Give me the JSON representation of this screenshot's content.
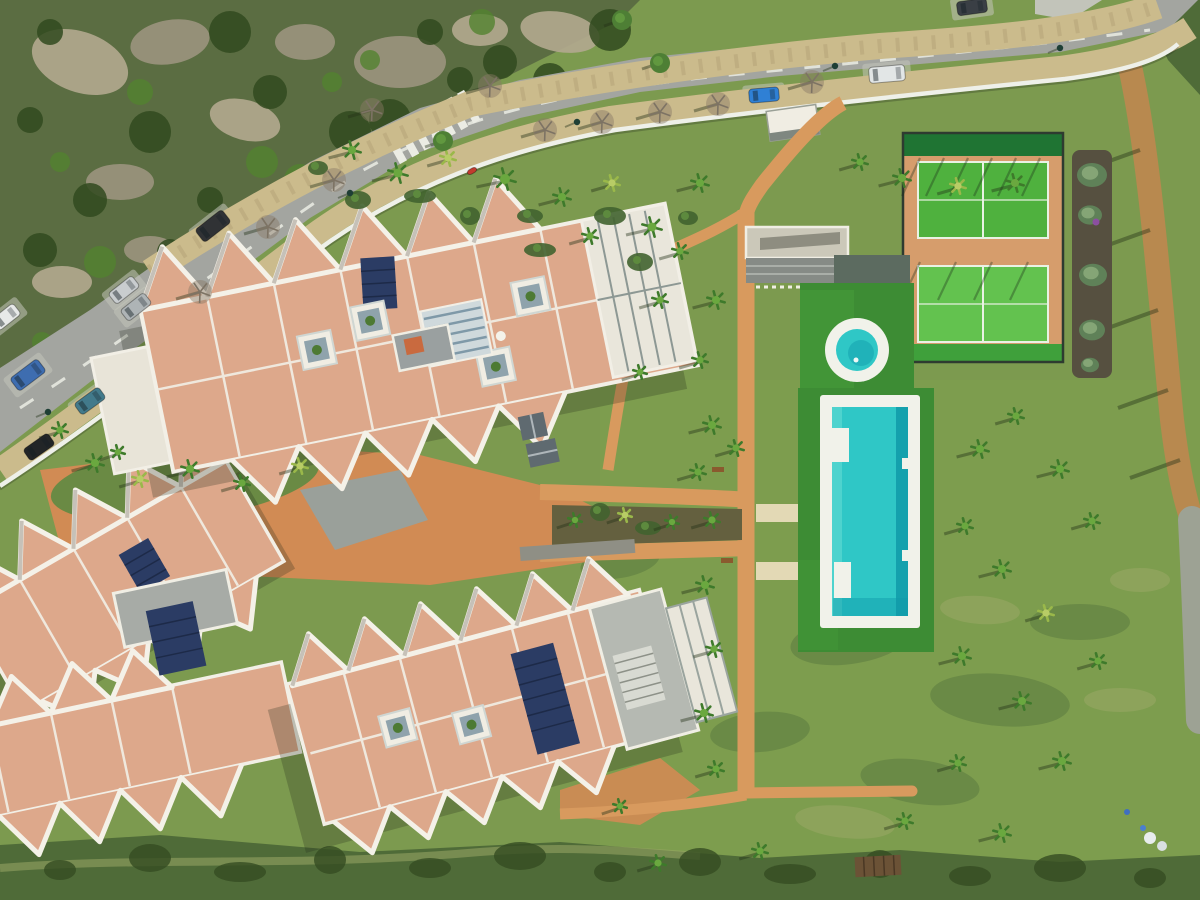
{
  "scene": {
    "name": "aerial-drone-view-residential-complex",
    "features": [
      "curved-road",
      "rocky-hillside",
      "apartment-blocks-zigzag-roofs",
      "orange-paths",
      "lap-pool",
      "round-plunge-pool",
      "padel-courts",
      "gardens",
      "scrubland"
    ]
  },
  "palette": {
    "grass": "#7c9a4f",
    "grassd": "#6a8a44",
    "meadow": "#7fa04e",
    "patchd": "#5b7a40",
    "patchl": "#9aa766",
    "scrub": "#4f6b38",
    "scrubd": "#344c22",
    "hill": "#5b6d42",
    "rock": "#9b947e",
    "rockl": "#b2a98f",
    "bushd": "#314a1e",
    "bushb": "#538230",
    "road": "#a3a5a0",
    "bay": "#c2c4ba",
    "mark": "#ebece4",
    "walk": "#cbbb8c",
    "walkdot": "#a8996d",
    "wall": "#eef0e9",
    "path": "#d89a5e",
    "plaza": "#d18b54",
    "pathpale": "#e3d9b5",
    "soilbed": "#64603f",
    "gravel": "#8f8f85",
    "roof": "#dda88b",
    "roofd": "#c98f70",
    "ridge": "#f4f1e8",
    "bwhite": "#f0ede3",
    "slate": "#5f6a70",
    "grayroof": "#b5b9b2",
    "solar": "#2b3c64",
    "solarline": "#1d2a48",
    "court": "#4fb13e",
    "courtl": "#63c24f",
    "courtbandd": "#1f7433",
    "courtbandb": "#3fa03b",
    "courttc": "#d69d6c",
    "fence": "#2e3b30",
    "turf": "#3d8c34",
    "turfl": "#4aa23d",
    "pool": "#2fc7c6",
    "poold": "#0f9aa8",
    "pooll": "#56d6cf",
    "deck": "#f1f2ea",
    "soil": "#565040",
    "bedbush": "#5f8158",
    "bedbushl": "#8fae7e",
    "purple": "#8b4fa0",
    "trail": "#b8894f",
    "trailg": "#9da294",
    "palm": "#3e7a2b",
    "palml": "#6aa83f",
    "palmy": "#9ab84a",
    "shadow": "rgba(35,50,25,0.42)",
    "atrium": "#8fa3ac",
    "bench": "#8a5a2e",
    "pallet": "#6b5236"
  },
  "cars": [
    {
      "name": "dark-van",
      "x": 213,
      "y": 226,
      "w": 34,
      "h": 16,
      "a": -38,
      "c": "#303235"
    },
    {
      "name": "silver-car",
      "x": 124,
      "y": 290,
      "w": 30,
      "h": 14,
      "a": -38,
      "c": "#c9cdcf"
    },
    {
      "name": "gray-car",
      "x": 136,
      "y": 307,
      "w": 30,
      "h": 14,
      "a": -38,
      "c": "#aeb4b6"
    },
    {
      "name": "white-car",
      "x": 6,
      "y": 317,
      "w": 28,
      "h": 14,
      "a": -38,
      "c": "#e7e9e8"
    },
    {
      "name": "blue-van",
      "x": 28,
      "y": 375,
      "w": 34,
      "h": 16,
      "a": -37,
      "c": "#3e6db0"
    },
    {
      "name": "teal-car",
      "x": 90,
      "y": 401,
      "w": 30,
      "h": 14,
      "a": -36,
      "c": "#427a8b"
    },
    {
      "name": "black-car",
      "x": 39,
      "y": 447,
      "w": 30,
      "h": 14,
      "a": -35,
      "c": "#222527"
    },
    {
      "name": "blue-car",
      "x": 764,
      "y": 95,
      "w": 30,
      "h": 14,
      "a": -5,
      "c": "#2f80d5"
    },
    {
      "name": "white-van",
      "x": 887,
      "y": 74,
      "w": 36,
      "h": 16,
      "a": -5,
      "c": "#e2e6e6"
    },
    {
      "name": "dark-car",
      "x": 972,
      "y": 7,
      "w": 30,
      "h": 14,
      "a": -8,
      "c": "#3a3f45"
    },
    {
      "name": "red-moped",
      "x": 472,
      "y": 171,
      "w": 10,
      "h": 5,
      "a": -30,
      "c": "#c23b2e"
    }
  ],
  "palms": [
    {
      "x": 352,
      "y": 150,
      "r": 9
    },
    {
      "x": 398,
      "y": 173,
      "r": 10
    },
    {
      "x": 448,
      "y": 158,
      "r": 8,
      "t": 1
    },
    {
      "x": 505,
      "y": 179,
      "r": 11
    },
    {
      "x": 562,
      "y": 197,
      "r": 9
    },
    {
      "x": 612,
      "y": 183,
      "r": 8,
      "t": 1
    },
    {
      "x": 652,
      "y": 227,
      "r": 10
    },
    {
      "x": 700,
      "y": 183,
      "r": 9
    },
    {
      "x": 590,
      "y": 236,
      "r": 8
    },
    {
      "x": 680,
      "y": 251,
      "r": 8
    },
    {
      "x": 860,
      "y": 162,
      "r": 8
    },
    {
      "x": 902,
      "y": 178,
      "r": 9
    },
    {
      "x": 958,
      "y": 186,
      "r": 8,
      "t": 1
    },
    {
      "x": 1015,
      "y": 183,
      "r": 9
    },
    {
      "x": 716,
      "y": 300,
      "r": 9
    },
    {
      "x": 700,
      "y": 360,
      "r": 8
    },
    {
      "x": 712,
      "y": 425,
      "r": 9
    },
    {
      "x": 736,
      "y": 448,
      "r": 8
    },
    {
      "x": 698,
      "y": 472,
      "r": 8
    },
    {
      "x": 712,
      "y": 520,
      "r": 8
    },
    {
      "x": 705,
      "y": 585,
      "r": 9
    },
    {
      "x": 714,
      "y": 649,
      "r": 8
    },
    {
      "x": 704,
      "y": 713,
      "r": 9
    },
    {
      "x": 716,
      "y": 769,
      "r": 8
    },
    {
      "x": 980,
      "y": 449,
      "r": 9
    },
    {
      "x": 1016,
      "y": 416,
      "r": 8
    },
    {
      "x": 1060,
      "y": 469,
      "r": 9
    },
    {
      "x": 1092,
      "y": 521,
      "r": 8
    },
    {
      "x": 965,
      "y": 526,
      "r": 8
    },
    {
      "x": 1002,
      "y": 569,
      "r": 9
    },
    {
      "x": 1046,
      "y": 613,
      "r": 8,
      "t": 1
    },
    {
      "x": 962,
      "y": 656,
      "r": 9
    },
    {
      "x": 1098,
      "y": 661,
      "r": 8
    },
    {
      "x": 1022,
      "y": 701,
      "r": 9
    },
    {
      "x": 958,
      "y": 763,
      "r": 8
    },
    {
      "x": 1062,
      "y": 761,
      "r": 9
    },
    {
      "x": 905,
      "y": 821,
      "r": 8
    },
    {
      "x": 1002,
      "y": 833,
      "r": 9
    },
    {
      "x": 760,
      "y": 851,
      "r": 8
    },
    {
      "x": 658,
      "y": 863,
      "r": 8
    },
    {
      "x": 620,
      "y": 806,
      "r": 7
    },
    {
      "x": 95,
      "y": 463,
      "r": 9
    },
    {
      "x": 140,
      "y": 479,
      "r": 8,
      "t": 1
    },
    {
      "x": 190,
      "y": 469,
      "r": 9
    },
    {
      "x": 242,
      "y": 483,
      "r": 8
    },
    {
      "x": 300,
      "y": 466,
      "r": 8,
      "t": 1
    },
    {
      "x": 575,
      "y": 520,
      "r": 7
    },
    {
      "x": 625,
      "y": 515,
      "r": 7,
      "t": 1
    },
    {
      "x": 672,
      "y": 522,
      "r": 7
    },
    {
      "x": 660,
      "y": 300,
      "r": 8
    },
    {
      "x": 640,
      "y": 372,
      "r": 7
    },
    {
      "x": 60,
      "y": 430,
      "r": 8
    },
    {
      "x": 118,
      "y": 452,
      "r": 7
    }
  ],
  "bare_trees": [
    {
      "x": 200,
      "y": 292
    },
    {
      "x": 268,
      "y": 227
    },
    {
      "x": 334,
      "y": 180
    },
    {
      "x": 372,
      "y": 110
    },
    {
      "x": 490,
      "y": 86
    },
    {
      "x": 545,
      "y": 130
    },
    {
      "x": 602,
      "y": 122
    },
    {
      "x": 660,
      "y": 112
    },
    {
      "x": 718,
      "y": 104
    },
    {
      "x": 812,
      "y": 82
    }
  ],
  "green_trees": [
    {
      "x": 443,
      "y": 141
    },
    {
      "x": 622,
      "y": 20
    },
    {
      "x": 660,
      "y": 63
    }
  ],
  "street_lights": [
    {
      "x": 350,
      "y": 193
    },
    {
      "x": 577,
      "y": 122
    },
    {
      "x": 835,
      "y": 66
    },
    {
      "x": 1060,
      "y": 48
    },
    {
      "x": 48,
      "y": 412
    }
  ],
  "shrubs": [
    {
      "x": 318,
      "y": 168
    },
    {
      "x": 358,
      "y": 200
    },
    {
      "x": 420,
      "y": 196
    },
    {
      "x": 470,
      "y": 216
    },
    {
      "x": 530,
      "y": 216
    },
    {
      "x": 610,
      "y": 216
    },
    {
      "x": 688,
      "y": 218
    },
    {
      "x": 640,
      "y": 262
    },
    {
      "x": 540,
      "y": 250
    },
    {
      "x": 600,
      "y": 512
    },
    {
      "x": 648,
      "y": 528
    }
  ],
  "bed_bushes": [
    {
      "x": 1092,
      "y": 175,
      "r": 15
    },
    {
      "x": 1090,
      "y": 215,
      "r": 12
    },
    {
      "x": 1093,
      "y": 275,
      "r": 14
    },
    {
      "x": 1092,
      "y": 330,
      "r": 13
    },
    {
      "x": 1090,
      "y": 365,
      "r": 9
    }
  ],
  "meadow_patches": [
    {
      "x": 850,
      "y": 640,
      "rx": 60,
      "ry": 24,
      "a": -8,
      "t": "d"
    },
    {
      "x": 1000,
      "y": 700,
      "rx": 70,
      "ry": 26,
      "a": 5,
      "t": "d"
    },
    {
      "x": 760,
      "y": 732,
      "rx": 50,
      "ry": 20,
      "a": -5,
      "t": "d"
    },
    {
      "x": 920,
      "y": 782,
      "rx": 60,
      "ry": 22,
      "a": 8,
      "t": "d"
    },
    {
      "x": 1080,
      "y": 622,
      "rx": 50,
      "ry": 18,
      "a": 0,
      "t": "d"
    },
    {
      "x": 620,
      "y": 562,
      "rx": 40,
      "ry": 16,
      "a": -10,
      "t": "d"
    },
    {
      "x": 890,
      "y": 560,
      "rx": 42,
      "ry": 14,
      "a": 0,
      "t": "l"
    },
    {
      "x": 1120,
      "y": 700,
      "rx": 36,
      "ry": 12,
      "a": 0,
      "t": "l"
    },
    {
      "x": 845,
      "y": 822,
      "rx": 50,
      "ry": 16,
      "a": 6,
      "t": "l"
    },
    {
      "x": 1140,
      "y": 580,
      "rx": 30,
      "ry": 12,
      "a": 0,
      "t": "l"
    },
    {
      "x": 980,
      "y": 610,
      "rx": 40,
      "ry": 14,
      "a": 4,
      "t": "l"
    },
    {
      "x": 500,
      "y": 545,
      "rx": 35,
      "ry": 13,
      "a": -6,
      "t": "d"
    }
  ],
  "scrub_blobs": [
    {
      "x": 60,
      "y": 870
    },
    {
      "x": 150,
      "y": 858
    },
    {
      "x": 240,
      "y": 872
    },
    {
      "x": 330,
      "y": 860
    },
    {
      "x": 430,
      "y": 868
    },
    {
      "x": 520,
      "y": 856
    },
    {
      "x": 610,
      "y": 872
    },
    {
      "x": 700,
      "y": 862
    },
    {
      "x": 790,
      "y": 874
    },
    {
      "x": 880,
      "y": 864
    },
    {
      "x": 970,
      "y": 876
    },
    {
      "x": 1060,
      "y": 868
    },
    {
      "x": 1150,
      "y": 878
    }
  ],
  "rocks": [
    {
      "x": 80,
      "y": 62,
      "rx": 50,
      "ry": 30,
      "a": 20
    },
    {
      "x": 170,
      "y": 42,
      "rx": 40,
      "ry": 22,
      "a": -10
    },
    {
      "x": 245,
      "y": 120,
      "rx": 36,
      "ry": 20,
      "a": 15
    },
    {
      "x": 400,
      "y": 62,
      "rx": 46,
      "ry": 26,
      "a": 0
    },
    {
      "x": 560,
      "y": 32,
      "rx": 40,
      "ry": 20,
      "a": 10
    },
    {
      "x": 120,
      "y": 182,
      "rx": 34,
      "ry": 18,
      "a": 0
    },
    {
      "x": 62,
      "y": 282,
      "rx": 30,
      "ry": 16,
      "a": 0
    },
    {
      "x": 305,
      "y": 42,
      "rx": 30,
      "ry": 18,
      "a": 0
    },
    {
      "x": 480,
      "y": 30,
      "rx": 28,
      "ry": 16,
      "a": 0
    },
    {
      "x": 150,
      "y": 250,
      "rx": 26,
      "ry": 14,
      "a": 0
    }
  ],
  "hill_bushes_dark": [
    {
      "x": 30,
      "y": 120
    },
    {
      "x": 90,
      "y": 200
    },
    {
      "x": 150,
      "y": 132
    },
    {
      "x": 210,
      "y": 200
    },
    {
      "x": 270,
      "y": 92
    },
    {
      "x": 350,
      "y": 132
    },
    {
      "x": 430,
      "y": 32
    },
    {
      "x": 500,
      "y": 62
    },
    {
      "x": 230,
      "y": 32
    },
    {
      "x": 50,
      "y": 32
    },
    {
      "x": 120,
      "y": 322
    },
    {
      "x": 200,
      "y": 302
    },
    {
      "x": 170,
      "y": 252
    },
    {
      "x": 260,
      "y": 222
    },
    {
      "x": 390,
      "y": 120
    },
    {
      "x": 460,
      "y": 80
    },
    {
      "x": 550,
      "y": 80
    },
    {
      "x": 610,
      "y": 30
    },
    {
      "x": 90,
      "y": 330
    },
    {
      "x": 40,
      "y": 250
    }
  ],
  "hill_bushes_bright": [
    {
      "x": 60,
      "y": 162
    },
    {
      "x": 140,
      "y": 92
    },
    {
      "x": 262,
      "y": 162
    },
    {
      "x": 332,
      "y": 82
    },
    {
      "x": 482,
      "y": 22
    },
    {
      "x": 100,
      "y": 262
    },
    {
      "x": 42,
      "y": 342
    },
    {
      "x": 202,
      "y": 262
    },
    {
      "x": 300,
      "y": 180
    },
    {
      "x": 370,
      "y": 60
    }
  ],
  "trail_shadows": [
    {
      "x": 1140,
      "y": 150
    },
    {
      "x": 1150,
      "y": 230
    },
    {
      "x": 1158,
      "y": 310
    },
    {
      "x": 1168,
      "y": 390
    },
    {
      "x": 1180,
      "y": 460
    }
  ],
  "debris": [
    {
      "x": 1150,
      "y": 838,
      "c": "#e8ecee",
      "r": 6
    },
    {
      "x": 1162,
      "y": 846,
      "c": "#d9dfe2",
      "r": 5
    },
    {
      "x": 1143,
      "y": 828,
      "c": "#4a7fd0",
      "r": 3
    },
    {
      "x": 1127,
      "y": 812,
      "c": "#3f6fc0",
      "r": 3
    }
  ]
}
